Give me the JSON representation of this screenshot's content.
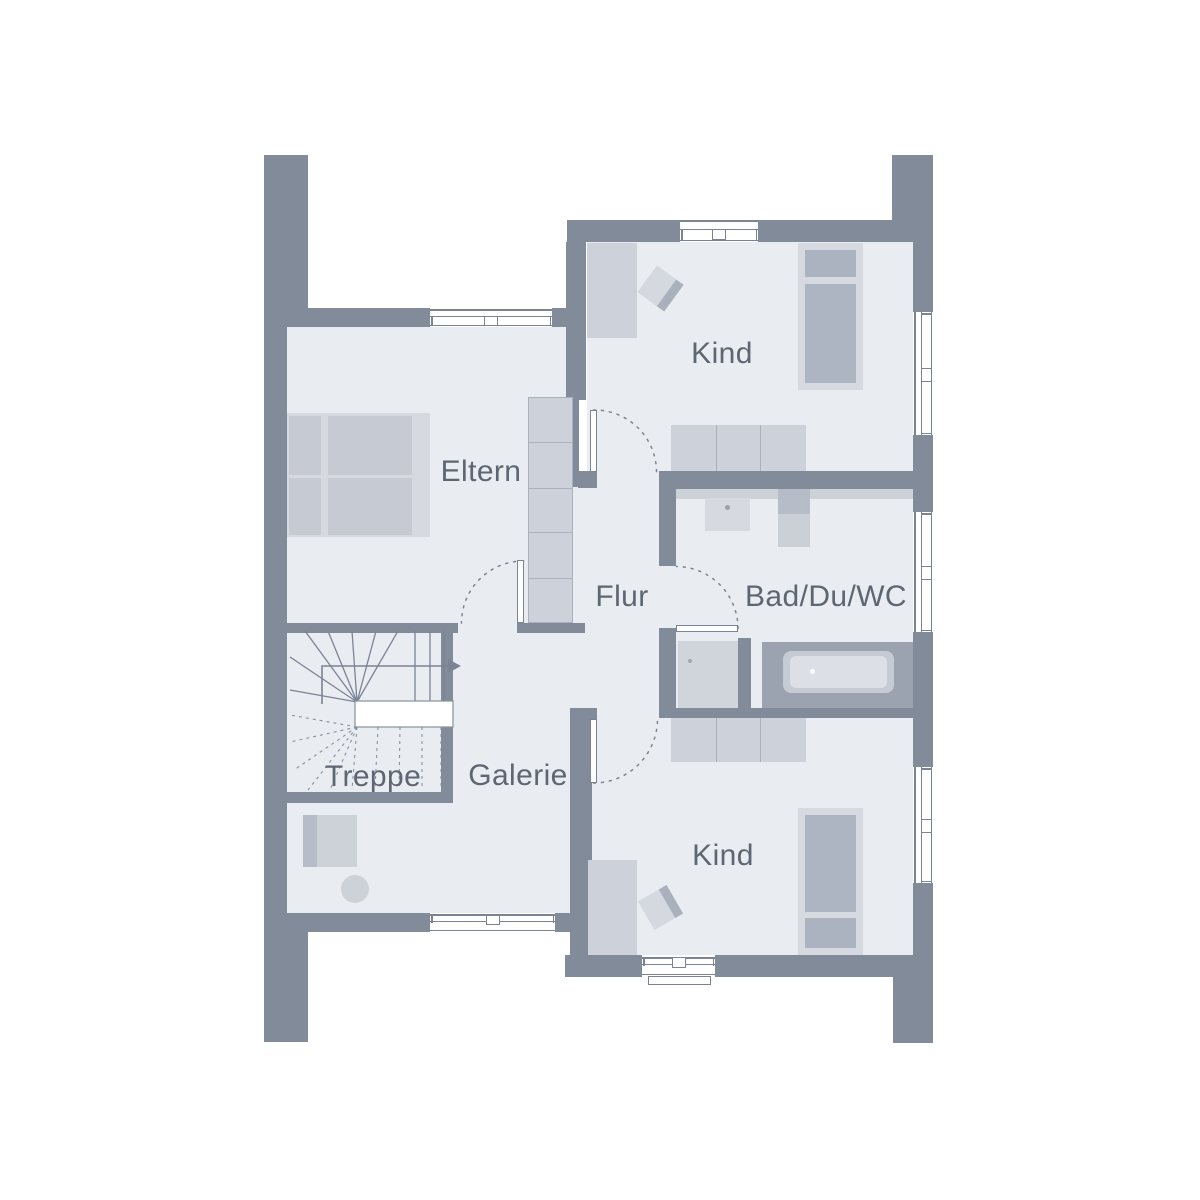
{
  "floorplan": {
    "rooms": {
      "eltern": {
        "label": "Eltern"
      },
      "kind_top": {
        "label": "Kind"
      },
      "flur": {
        "label": "Flur"
      },
      "bad": {
        "label": "Bad/Du/WC"
      },
      "treppe": {
        "label": "Treppe"
      },
      "galerie": {
        "label": "Galerie"
      },
      "kind_bottom": {
        "label": "Kind"
      }
    },
    "colors": {
      "background": "#ffffff",
      "wall": "#828b9a",
      "floor": "#e9ecf1",
      "furniture_light": "#d6d9e0",
      "furniture_mid": "#cdd2da",
      "furniture_dark": "#aeb5c2",
      "pillow": "#abb3c0",
      "tub_surround": "#9ba3b0",
      "line": "#7b8495",
      "text": "#5d6673"
    }
  }
}
